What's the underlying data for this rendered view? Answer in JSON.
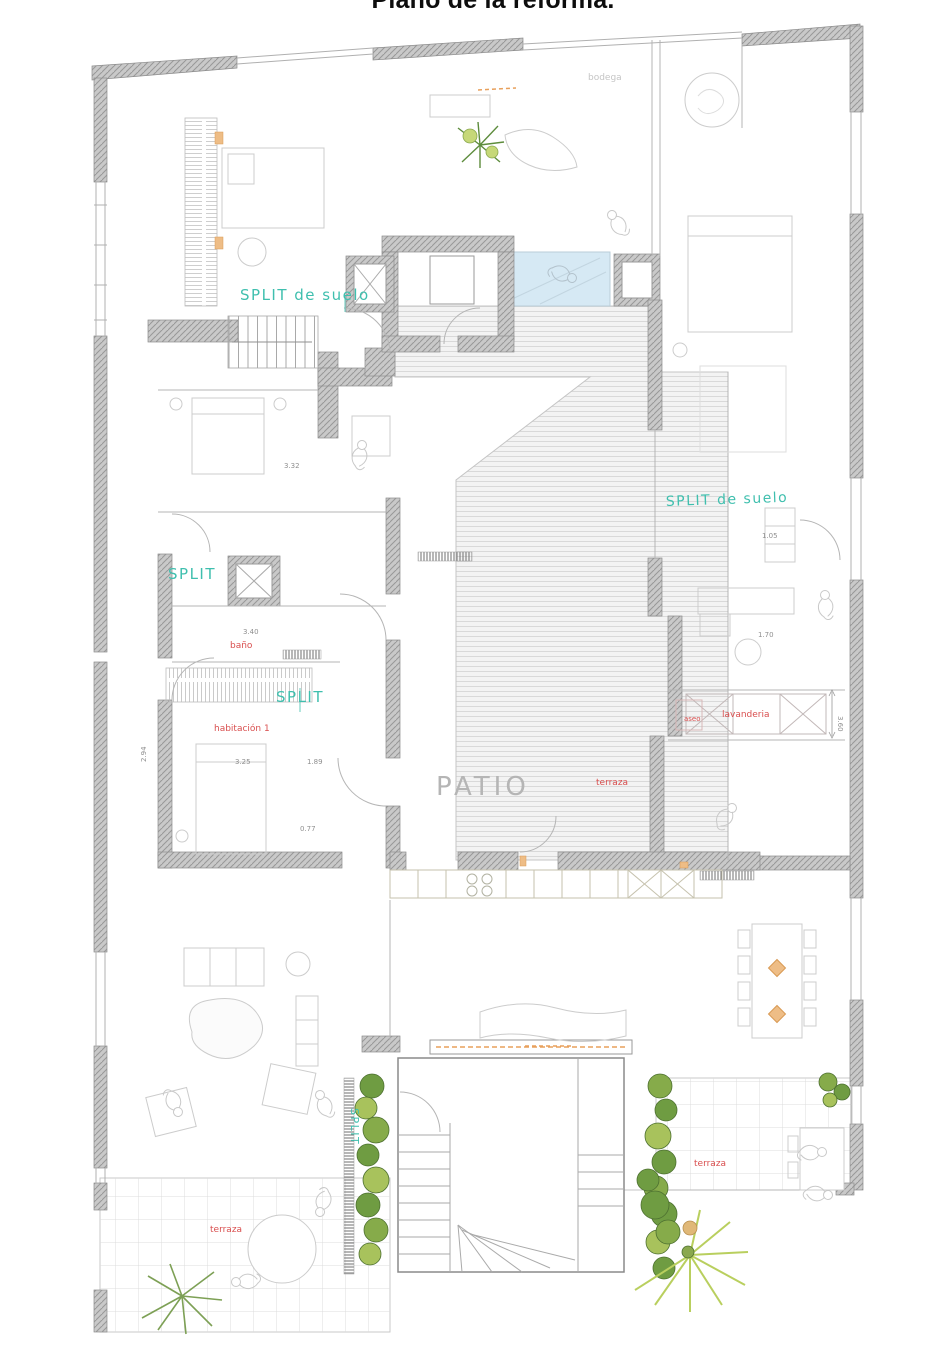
{
  "title": "Plano de la reforma.",
  "colors": {
    "label_teal": "#3fbfae",
    "label_red": "#d94f4f",
    "label_gray": "#b5b5b5",
    "dim_gray": "#8f8f8f",
    "faint_gray": "#c5c5c5",
    "wall_gray": "#c9c9c9",
    "pool_blue": "#d6e9f4",
    "plant_dark": "#5f8f3f",
    "plant_light": "#b9cf5e",
    "accent_orange": "#e8a05c"
  },
  "labels": {
    "patio": "PATIO",
    "split_floor_left": "SPLIT de suelo",
    "split_floor_right": "SPLIT de suelo",
    "split_shaft": "SPLIT",
    "split_closet": "SPLIT",
    "split_radiator": "SPLIT",
    "bathroom": "baño",
    "bedroom1": "habitación 1",
    "toilet": "aseo",
    "laundry": "lavanderia",
    "terrace_patio": "terraza",
    "terrace_right": "terraza",
    "terrace_left": "terraza",
    "storage": "bodega"
  },
  "dimensions": {
    "bedroom2_width": "3.32",
    "bathroom_width": "3.40",
    "bedroom1_left": "2.94",
    "bedroom1_width": "3.25",
    "hall_width": "1.89",
    "corridor_width": "0.77",
    "laundry_depth": "3.60",
    "closet_width": "1.70",
    "cabinet_width": "1.05"
  }
}
